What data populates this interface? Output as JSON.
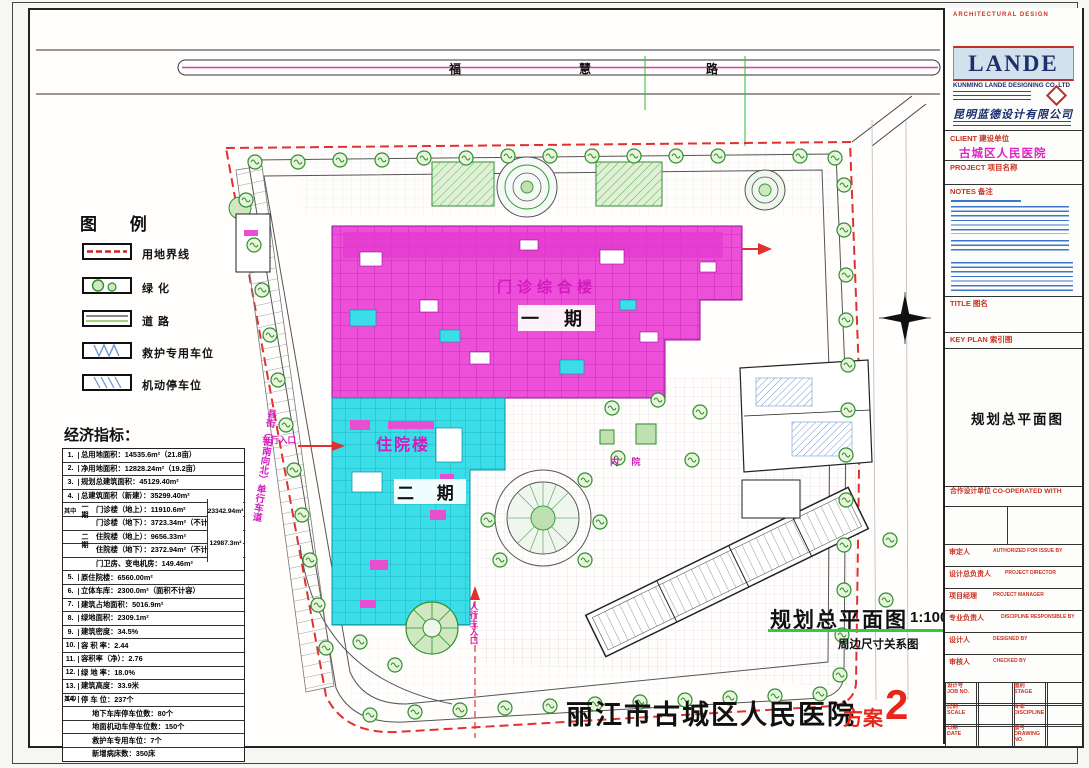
{
  "plan": {
    "road_name": "福慧路",
    "road_chars": [
      "福",
      "慧",
      "路"
    ],
    "buildings": {
      "outpatient": "门诊综合楼",
      "phase1": "一 期",
      "inpatient": "住院楼",
      "phase2": "二 期",
      "courtyard": "内 院"
    },
    "entrances": {
      "vehicle": "车行入口",
      "main": "人行主入口"
    },
    "side_road": "县街（由南向北）单行车道",
    "drawing_title": "规划总平面图",
    "drawing_scale": "1:100",
    "drawing_subtitle": "周边尺寸关系图"
  },
  "legend": {
    "title": "图  例",
    "items": [
      "用地界线",
      "绿    化",
      "道    路",
      "救护专用车位",
      "机动停车位"
    ]
  },
  "economic": {
    "title": "经济指标：",
    "among": "其中",
    "phase1": "一期",
    "phase2": "二期",
    "totals": {
      "phase1": "23342.94m²",
      "phase2": "12987.3m²"
    },
    "rows": [
      {
        "no": "1.",
        "text": "总用地面积：14535.6m²（21.8亩）"
      },
      {
        "no": "2.",
        "text": "净用地面积：12828.24m²（19.2亩）"
      },
      {
        "no": "3.",
        "text": "规划总建筑面积：45129.40m²"
      },
      {
        "no": "4.",
        "text": "总建筑面积（新建）：35299.40m²"
      },
      {
        "no": "",
        "text": "门诊楼（地上）：11910.6m²"
      },
      {
        "no": "",
        "text": "门诊楼（地下）：3723.34m²（不计容）"
      },
      {
        "no": "",
        "text": "住院楼（地上）：9656.33m²"
      },
      {
        "no": "",
        "text": "住院楼（地下）：2372.94m²（不计容）"
      },
      {
        "no": "",
        "text": "门卫房、变电机房：149.46m²"
      },
      {
        "no": "5.",
        "text": "原住院楼：6560.00m²"
      },
      {
        "no": "6.",
        "text": "立体车库：2300.0m²（面积不计容）"
      },
      {
        "no": "7.",
        "text": "建筑占地面积：5016.9m²"
      },
      {
        "no": "8.",
        "text": "绿地面积：2309.1m²"
      },
      {
        "no": "9.",
        "text": "建筑密度：34.5%"
      },
      {
        "no": "10.",
        "text": "容 积 率：2.44"
      },
      {
        "no": "11.",
        "text": "容积率（净）：2.76"
      },
      {
        "no": "12.",
        "text": "绿 地 率：18.0%"
      },
      {
        "no": "13.",
        "text": "建筑高度：33.9米"
      },
      {
        "no": "14.",
        "text": "停 车 位：237个"
      },
      {
        "no": "",
        "text": "地下车库停车位数：80个"
      },
      {
        "no": "",
        "text": "地面机动车停车位数：150个"
      },
      {
        "no": "",
        "text": "救护车专用车位：7个"
      },
      {
        "no": "",
        "text": "新增病床数：350床"
      }
    ]
  },
  "footer": {
    "project": "丽江市古城区人民医院",
    "scheme_label": "方案",
    "scheme_number": "2"
  },
  "titleblock": {
    "discipline_header": "ARCHITECTURAL DESIGN",
    "logo": "LANDE",
    "company_en": "KUNMING LANDE DESIGNING CO.,LTD",
    "company_cn": "昆明蓝德设计有限公司",
    "client_label": "CLIENT 建设单位",
    "client_value": "古城区人民医院",
    "project_label": "PROJECT 项目名称",
    "notes_label": "NOTES 备注",
    "title_label": "TITLE 图名",
    "keyplan_label": "KEY PLAN 索引图",
    "sheet_title": "规划总平面图",
    "coop_label": "合作设计单位 CO-OPERATED WITH",
    "fields": [
      {
        "cn": "审定人",
        "en": "AUTHORIZED FOR ISSUE BY"
      },
      {
        "cn": "设计总负责人",
        "en": "PROJECT DIRECTOR"
      },
      {
        "cn": "项目经理",
        "en": "PROJECT MANAGER"
      },
      {
        "cn": "专业负责人",
        "en": "DISCIPLINE RESPONSIBLE BY"
      },
      {
        "cn": "设计人",
        "en": "DESIGNED BY"
      },
      {
        "cn": "审核人",
        "en": "CHECKED BY"
      }
    ],
    "grid": [
      {
        "cn": "设计号",
        "en": "JOB NO."
      },
      {
        "cn": "图别",
        "en": "STAGE"
      },
      {
        "cn": "比例",
        "en": "SCALE"
      },
      {
        "cn": "专业",
        "en": "DISCIPLINE"
      },
      {
        "cn": "日期",
        "en": "DATE"
      },
      {
        "cn": "图号",
        "en": "DRAWING NO."
      }
    ]
  },
  "colors": {
    "boundary_red": "#e03030",
    "outpatient_fill": "#ee4fd8",
    "inpatient_fill": "#3adde8",
    "label_magenta": "#d21bbe",
    "scheme_red": "#e8261a",
    "green": "#2f8f2f",
    "hatch_blue": "#6f9bd2",
    "navy": "#1c2f6e",
    "panel_red": "#cc3322"
  }
}
